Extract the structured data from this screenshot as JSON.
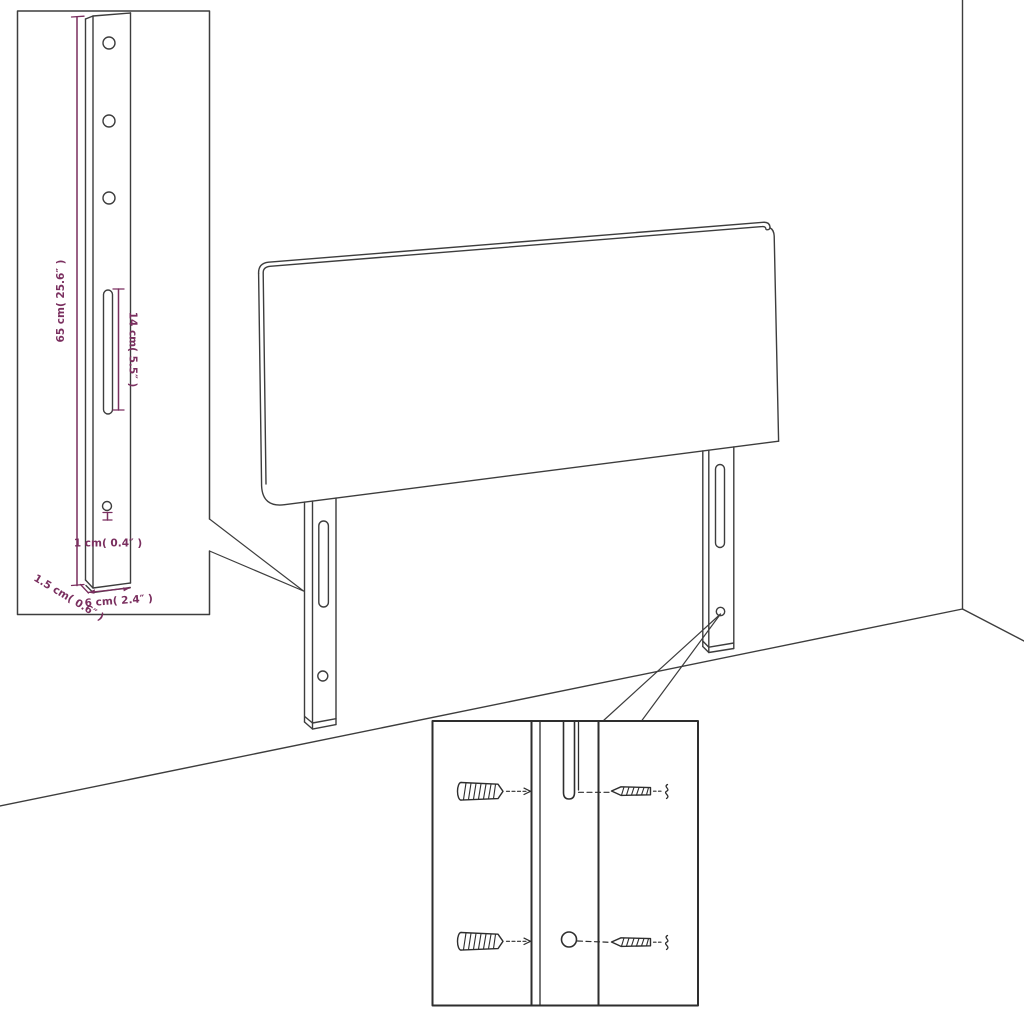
{
  "diagram_title": "headboard-mounting-leg-dimension-diagram",
  "colors": {
    "line": "#3d3d3d",
    "detail_line": "#2e2e2e",
    "dimension": "#7a2f5f",
    "background": "#ffffff"
  },
  "detail_leg": {
    "height_label": "65 cm( 25.6″ )",
    "slot_label": "14 cm( 5.5″ )",
    "hole_label": "1 cm( 0.4″ )",
    "thickness_label": "1.5 cm( 0.6″ )",
    "width_label": "6 cm( 2.4″ )"
  }
}
